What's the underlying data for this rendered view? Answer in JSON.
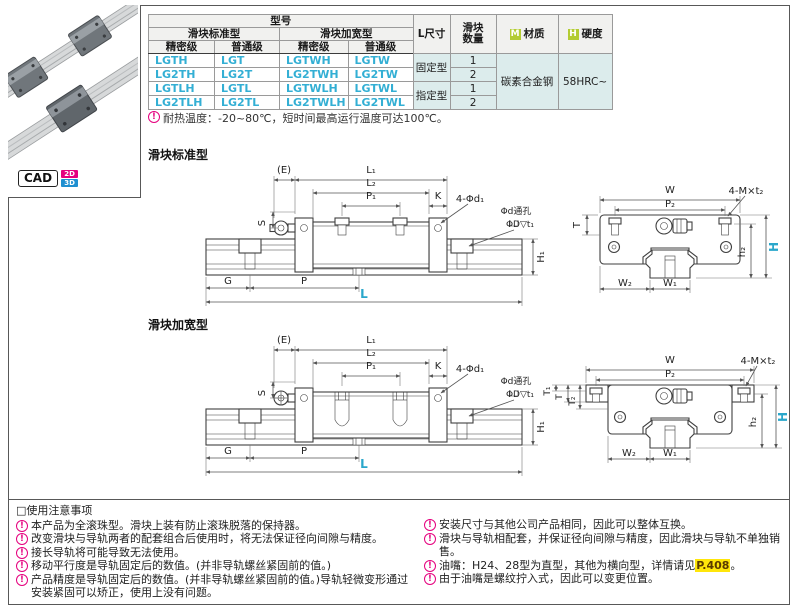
{
  "colors": {
    "accent_cyan": "#2AA7CB",
    "model_link_cyan": "#33AFD4",
    "badge_green": "#B3CC33",
    "note_magenta": "#E5007E",
    "highlight_yellow": "#FFE60A",
    "cell_bg_cyan": "#DCECEC",
    "header_bg": "#F1F1EF"
  },
  "product_panel": {
    "cad_label": "CAD",
    "cad_2d": "2D",
    "cad_3d": "3D"
  },
  "spec_table": {
    "headers": {
      "model_no": "型号",
      "slider_standard": "滑块标准型",
      "slider_widened": "滑块加宽型",
      "precision": "精密级",
      "normal": "普通级",
      "l_size": "L尺寸",
      "slider_qty": "滑块\n数量",
      "material_badge": "M",
      "material": "材质",
      "hardness_badge": "H",
      "hardness": "硬度"
    },
    "rows": [
      {
        "precision_std": "LGTH",
        "normal_std": "LGT",
        "precision_wide": "LGTWH",
        "normal_wide": "LGTW",
        "l_size": "固定型",
        "qty": "1"
      },
      {
        "precision_std": "LG2TH",
        "normal_std": "LG2T",
        "precision_wide": "LG2TWH",
        "normal_wide": "LG2TW",
        "qty": "2"
      },
      {
        "precision_std": "LGTLH",
        "normal_std": "LGTL",
        "precision_wide": "LGTWLH",
        "normal_wide": "LGTWL",
        "l_size": "指定型",
        "qty": "1"
      },
      {
        "precision_std": "LG2TLH",
        "normal_std": "LG2TL",
        "precision_wide": "LG2TWLH",
        "normal_wide": "LG2TWL",
        "qty": "2"
      }
    ],
    "material_value": "碳素合金钢",
    "hardness_value": "58HRC~",
    "footnote": "耐热温度：-20~80℃，短时间最高运行温度可达100℃。"
  },
  "sections": {
    "standard": "滑块标准型",
    "widened": "滑块加宽型"
  },
  "dims": {
    "e": "(E)",
    "l1": "L₁",
    "l2": "L₂",
    "p1": "P₁",
    "k": "K",
    "d1": "4-Φd₁",
    "s": "S",
    "through_hole": "Φd通孔",
    "counterbore": "ΦD▽t₁",
    "h1": "H₁",
    "g": "G",
    "p": "P",
    "l": "L",
    "w": "W",
    "p2": "P₂",
    "mt2": "4-M×t₂",
    "t": "T",
    "t1": "T₁",
    "t2": "T₂",
    "h2": "h₂",
    "h": "H",
    "w2": "W₂",
    "w1": "W₁"
  },
  "usage_notes": {
    "icon_glyph": "!",
    "title": "□使用注意事项",
    "left": [
      "本产品为全滚珠型。滑块上装有防止滚珠脱落的保持器。",
      "改变滑块与导轨两者的配套组合后使用时，将无法保证径向间隙与精度。",
      "接长导轨将可能导致无法使用。",
      "移动平行度是导轨固定后的数值。(并非导轨螺丝紧固前的值。)",
      "产品精度是导轨固定后的数值。(并非导轨螺丝紧固前的值。)导轨轻微变形通过安装紧固可以矫正，使用上没有问题。"
    ],
    "right": [
      {
        "text": "安装尺寸与其他公司产品相同，因此可以整体互换。",
        "highlight": "",
        "suffix": ""
      },
      {
        "text": "滑块与导轨相配套，并保证径向间隙与精度，因此滑块与导轨不单独销售。",
        "highlight": "",
        "suffix": ""
      },
      {
        "text": "油嘴：H24、28型为直型，其他为横向型，详情请见",
        "highlight": "P.408",
        "suffix": "。"
      },
      {
        "text": "由于油嘴是螺纹拧入式，因此可以变更位置。",
        "highlight": "",
        "suffix": ""
      }
    ]
  }
}
